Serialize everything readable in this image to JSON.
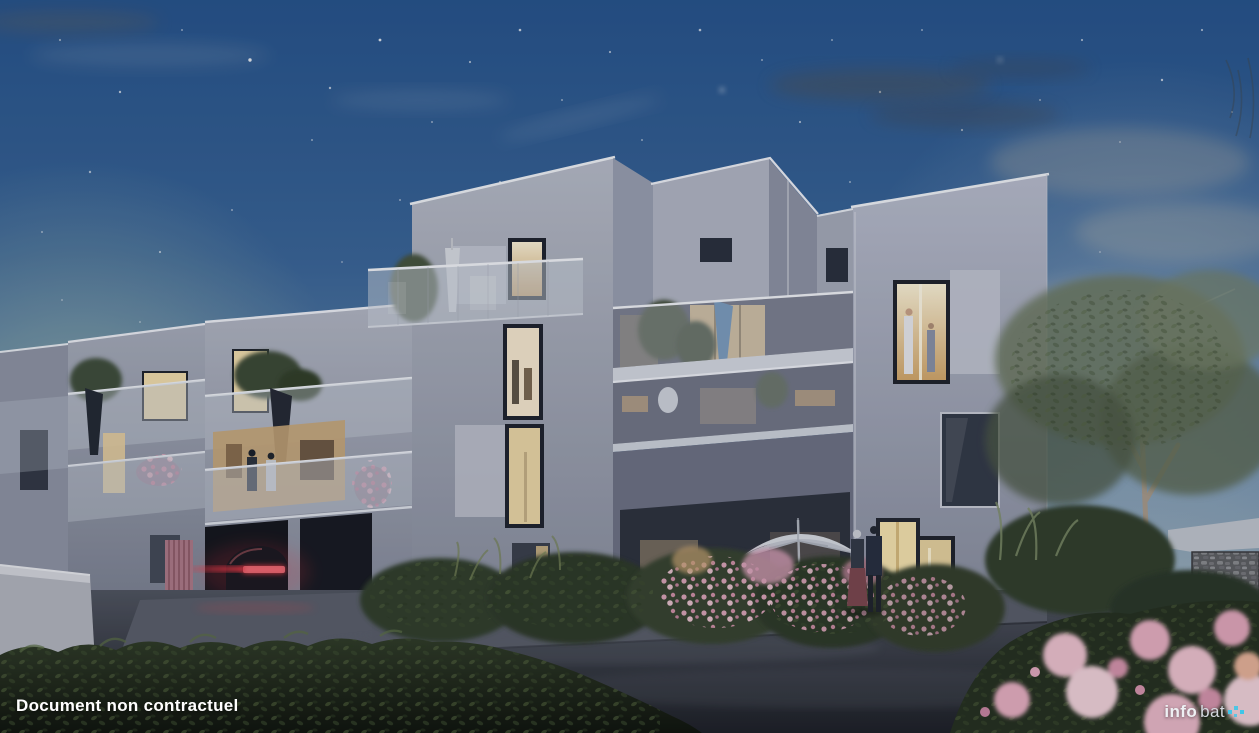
{
  "watermark": {
    "text": "Document non contractuel"
  },
  "logo": {
    "prefix": "info",
    "suffix": "bat",
    "mark": "cyan-pixel-mark"
  },
  "scene": {
    "subject": "apartment-building-dusk-rendering",
    "elements": [
      "night-sky-stars",
      "three-storey-building",
      "glass-balconies",
      "lit-windows",
      "garage-red-car",
      "entrance-couple",
      "white-parasol",
      "blue-parasol",
      "hedge",
      "pink-roses",
      "tree"
    ]
  },
  "colors": {
    "sky_top": "#27558e",
    "sky_mid": "#5d82a8",
    "sky_horizon": "#bcc6c0",
    "window_lit": "#f3dfae",
    "taillight_red": "#ff3b4a",
    "flower_pink": "#e3aabf",
    "asphalt": "#3a3e49",
    "facade_light": "#b8bdc9",
    "logo_cyan": "#3fc6e8",
    "text_white": "#ffffff"
  }
}
